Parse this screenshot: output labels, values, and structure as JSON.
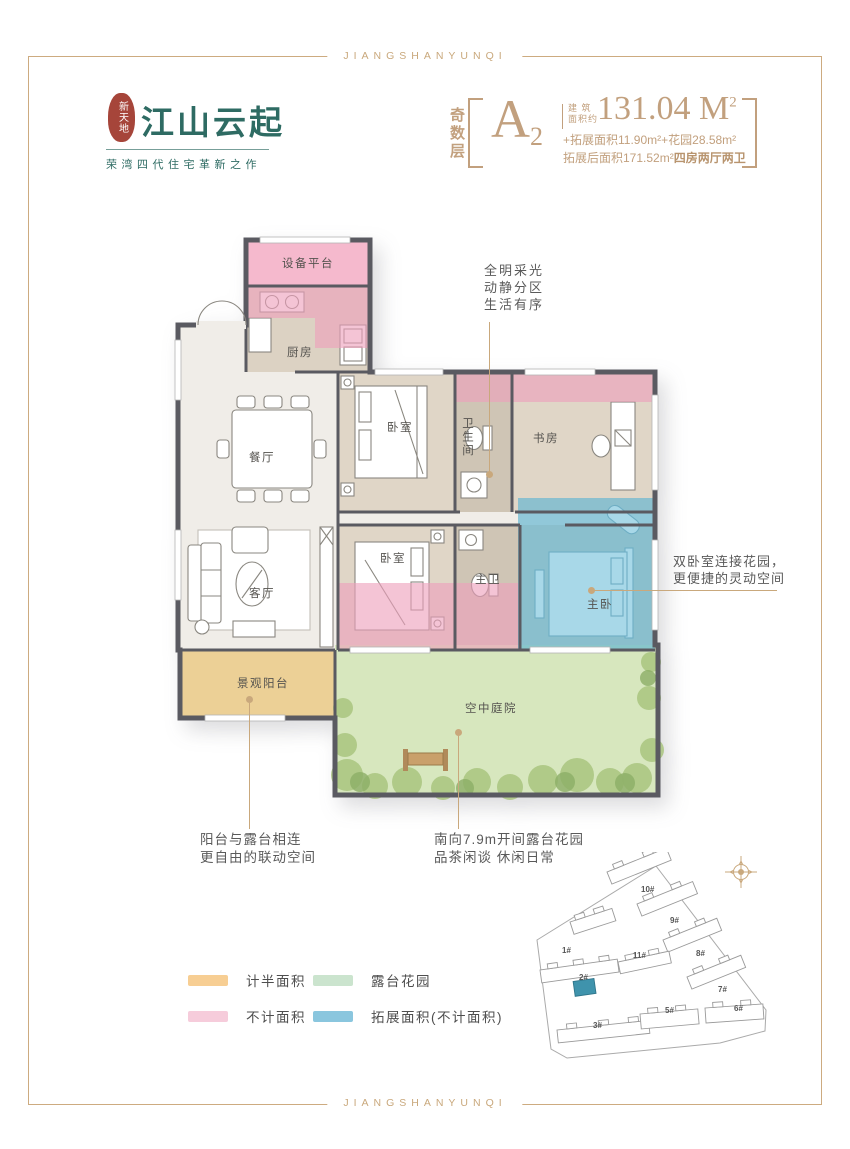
{
  "frame": {
    "top_text": "JIANGSHANYUNQI",
    "bottom_text": "JIANGSHANYUNQI"
  },
  "brand": {
    "seal_text": "新天地",
    "name": "江山云起",
    "tagline": "荣湾四代住宅革新之作"
  },
  "spec": {
    "floor_type": "奇数层",
    "unit_name": "A",
    "unit_sub": "2",
    "area_label_line1": "建 筑",
    "area_label_line2": "面积约",
    "area_value": "131.04 M",
    "area_sup": "2",
    "detail_line1": "+拓展面积11.90m²+花园28.58m²",
    "detail_line2_normal": "拓展后面积171.52m²",
    "detail_line2_bold": "四房两厅两卫"
  },
  "plan": {
    "rooms": [
      {
        "id": "equipment-platform",
        "label": "设备平台"
      },
      {
        "id": "kitchen",
        "label": "厨房"
      },
      {
        "id": "dining",
        "label": "餐厅"
      },
      {
        "id": "bedroom-1",
        "label": "卧室"
      },
      {
        "id": "bathroom",
        "label": "卫生间"
      },
      {
        "id": "study",
        "label": "书房"
      },
      {
        "id": "living",
        "label": "客厅"
      },
      {
        "id": "bedroom-2",
        "label": "卧室"
      },
      {
        "id": "master-bath",
        "label": "主卫"
      },
      {
        "id": "master-bedroom",
        "label": "主卧"
      },
      {
        "id": "balcony",
        "label": "景观阳台"
      },
      {
        "id": "sky-courtyard",
        "label": "空中庭院"
      }
    ],
    "annotations": {
      "top": [
        "全明采光",
        "动静分区",
        "生活有序"
      ],
      "right": [
        "双卧室连接花园，",
        "更便捷的灵动空间"
      ],
      "bottom_left": [
        "阳台与露台相连",
        "更自由的联动空间"
      ],
      "bottom_middle": [
        "南向7.9m开间露台花园",
        "品茶闲谈 休闲日常"
      ]
    }
  },
  "legend": {
    "items": [
      {
        "label": "计半面积",
        "color": "#f7ce93"
      },
      {
        "label": "露台花园",
        "color": "#cbe4ce"
      },
      {
        "label": "不计面积",
        "color": "#f6ccdb"
      },
      {
        "label": "拓展面积(不计面积)",
        "color": "#8ac6de"
      }
    ]
  },
  "siteplan": {
    "buildings": [
      {
        "label": "1#"
      },
      {
        "label": "2#"
      },
      {
        "label": "3#"
      },
      {
        "label": "5#"
      },
      {
        "label": "6#"
      },
      {
        "label": "7#"
      },
      {
        "label": "8#"
      },
      {
        "label": "9#"
      },
      {
        "label": "10#"
      },
      {
        "label": "11#"
      }
    ]
  },
  "colors": {
    "accent": "#c9a87c",
    "spec_text": "#c2a07e",
    "brand_teal": "#2e6b63",
    "seal_red": "#a6453a",
    "wall_gray": "#5a5a61",
    "pink_area": "#f5b9cd",
    "pink_overlay": "#ed9fbc",
    "blue_extension": "#5fb4d2",
    "garden_green": "#d7e7be",
    "balcony_tan": "#ecd096",
    "site_highlight": "#3f93ac"
  }
}
